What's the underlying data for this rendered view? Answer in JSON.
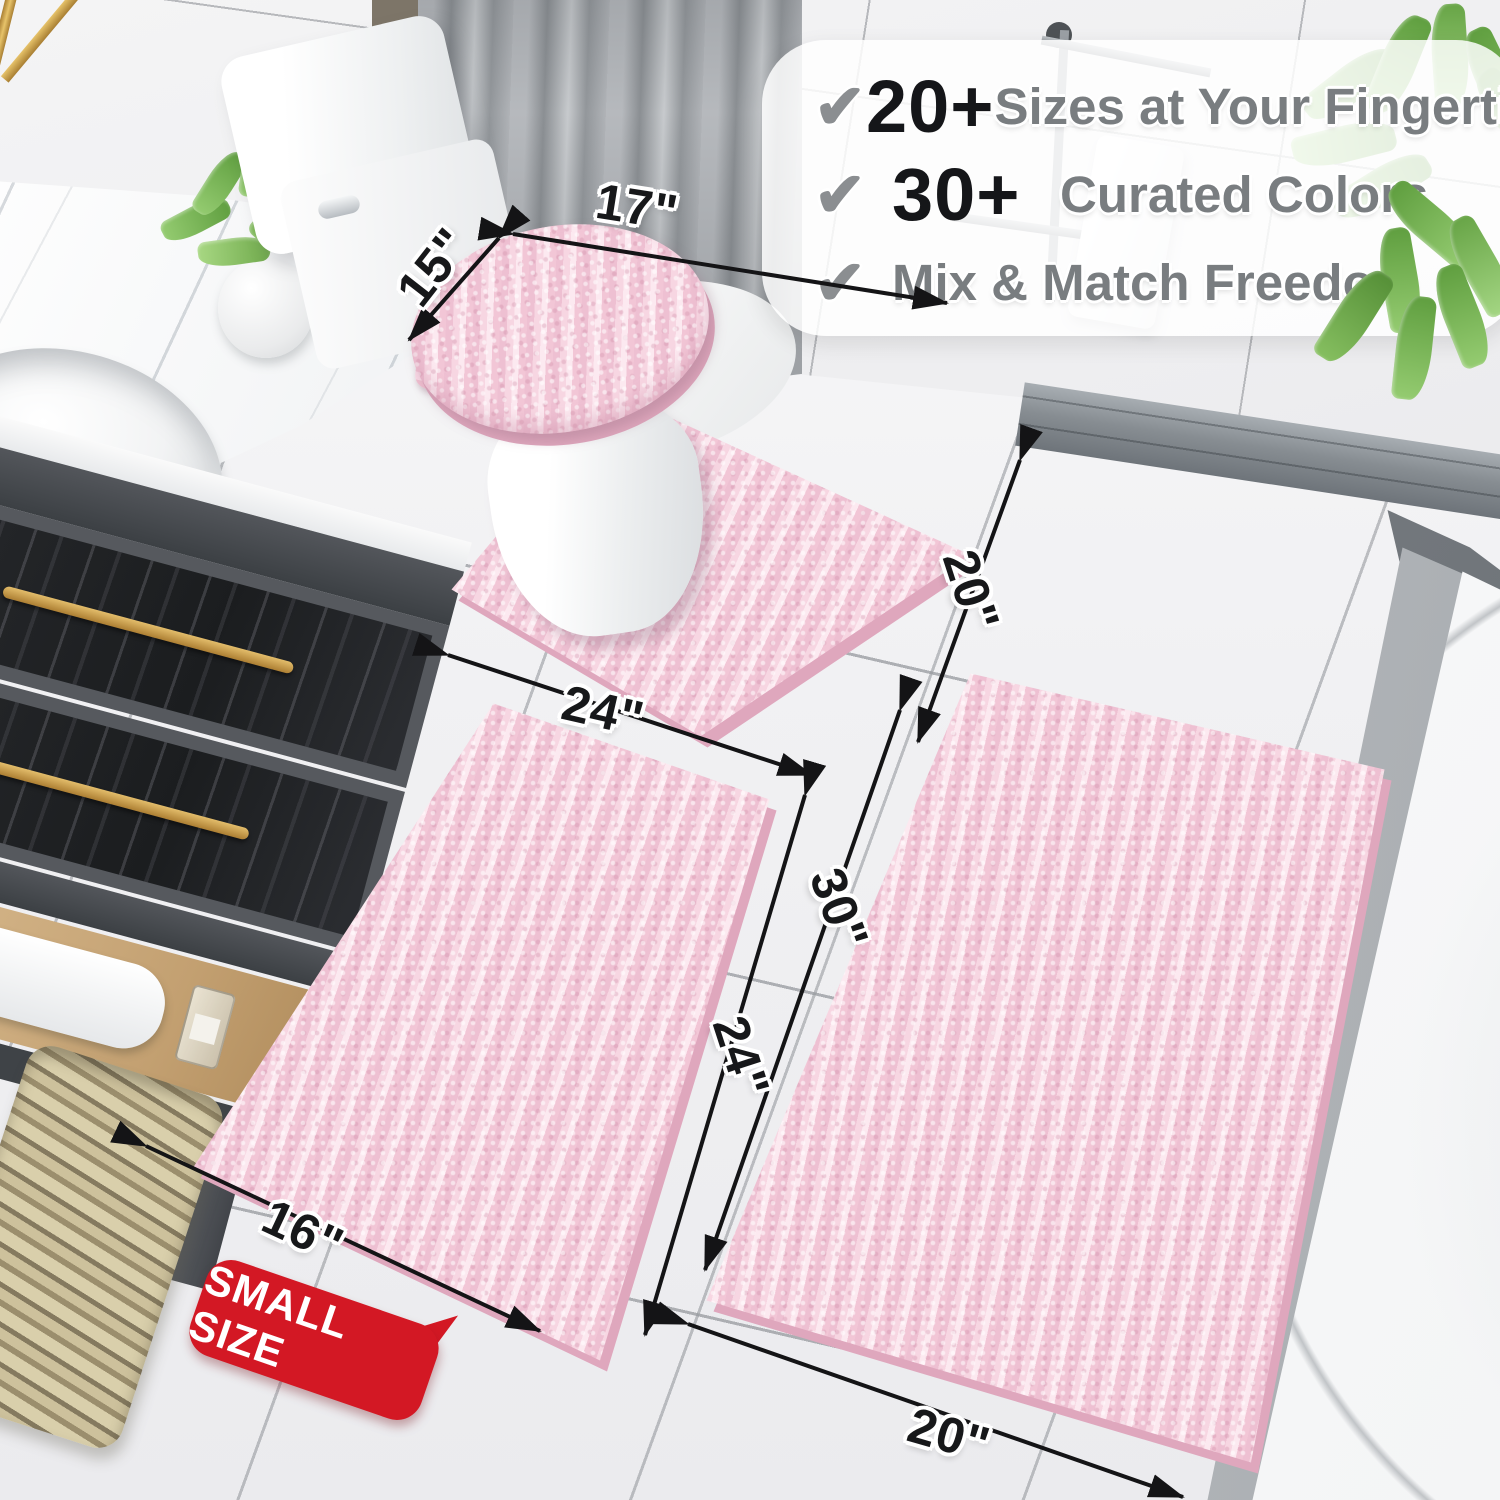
{
  "checklist": {
    "check": "✔",
    "rows": [
      {
        "value": "20+",
        "label": "Sizes at Your Fingertips"
      },
      {
        "value": "30+",
        "label": "Curated Colors"
      },
      {
        "value": "",
        "label": "Mix & Match Freedom"
      }
    ]
  },
  "dims": {
    "lid_width": "17\"",
    "lid_depth": "15\"",
    "contour_width": "24\"",
    "contour_depth": "20\"",
    "small_rug_width": "16\"",
    "small_rug_length": "24\"",
    "large_rug_length": "30\"",
    "large_rug_width": "20\""
  },
  "badge": {
    "text": "SMALL SIZE"
  },
  "colors": {
    "mat_pink": "#f4cddb",
    "mat_pink_dark": "#dfa7bd",
    "badge_red": "#d31824",
    "check_gray": "#8b8e91",
    "value_black": "#151619",
    "label_gray": "#797d80",
    "arrow_black": "#141416",
    "gold": "#c9a254"
  }
}
